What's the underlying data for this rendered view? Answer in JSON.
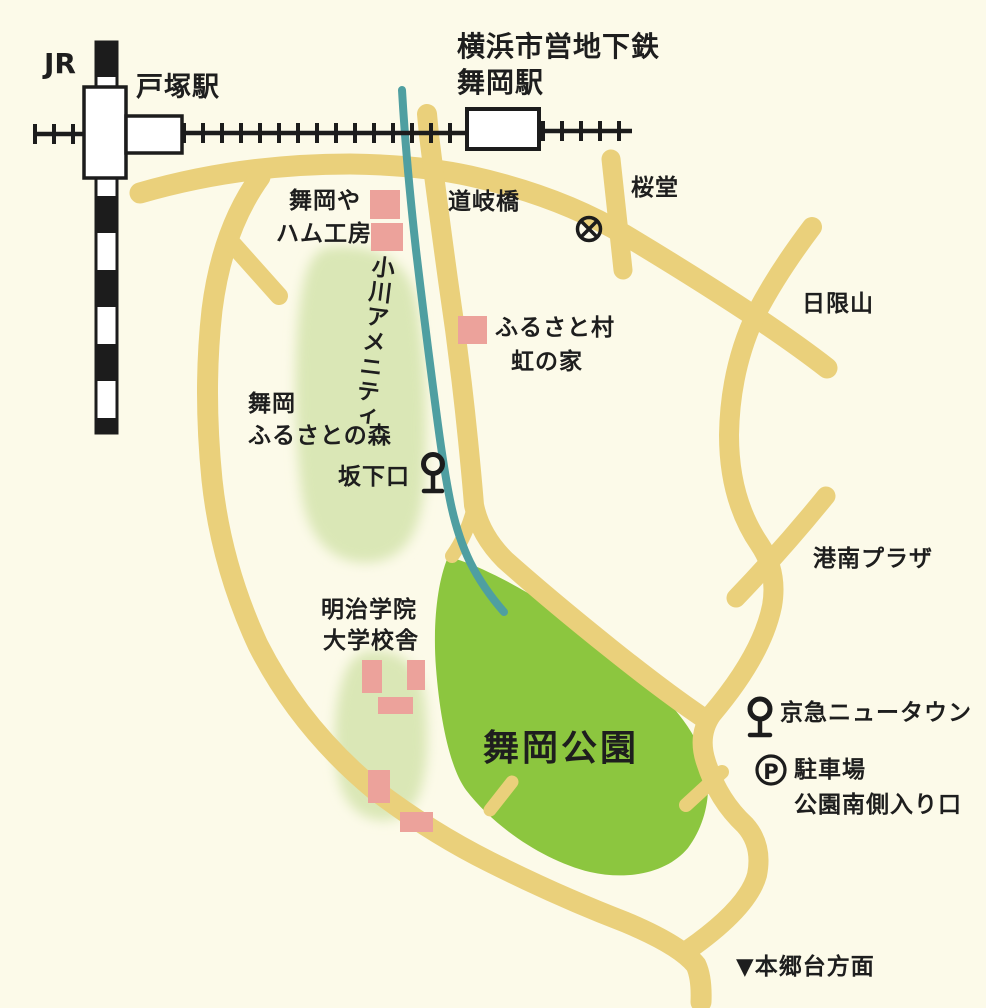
{
  "map": {
    "stations": {
      "jr_label": "JR",
      "totsuka": "戸塚駅",
      "subway_company": "横浜市営地下鉄",
      "maioka": "舞岡駅"
    },
    "places": {
      "michimata_bridge": "道岐橋",
      "sakuradou": "桜堂",
      "maiokaya": "舞岡や",
      "ham_workshop": "ハム工房",
      "ogawa_amenity": "小川アメニティ",
      "furusato_village": "ふるさと村",
      "niji_no_ie": "虹の家",
      "higiriyama": "日限山",
      "maioka_forest_line1": "舞岡",
      "maioka_forest_line2": "ふるさとの森",
      "sakashita_entrance": "坂下口",
      "kounan_plaza": "港南プラザ",
      "meiji_gakuin_line1": "明治学院",
      "meiji_gakuin_line2": "大学校舎",
      "maioka_park": "舞岡公園",
      "keikyu_newtown": "京急ニュータウン",
      "parking": "駐車場",
      "parking_symbol": "P",
      "park_south_entrance": "公園南側入り口",
      "hongodai_direction": "▼本郷台方面"
    },
    "colors": {
      "background": "#FCFAE9",
      "road_yellow": "#EAD07B",
      "park_green": "#8CC63F",
      "forest_light_green": "#DAE7B6",
      "stream_teal": "#4F9FA1",
      "building_pink": "#ECA29B",
      "railway_black": "#1C1C1C",
      "station_white": "#FFFFFF",
      "text": "#1E1E1E"
    }
  }
}
